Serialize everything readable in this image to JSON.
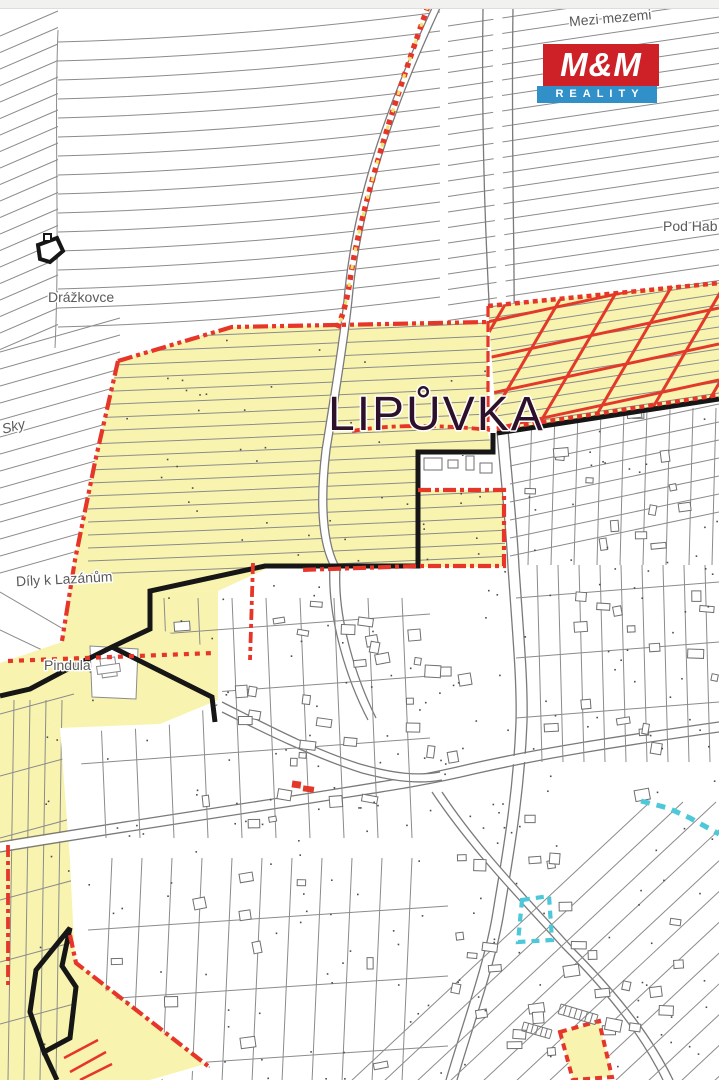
{
  "page": {
    "top_bar_color": "#f1f1ef"
  },
  "logo": {
    "brand": "M&M",
    "tagline": "REALITY",
    "red": "#ce2127",
    "blue": "#3090c7"
  },
  "map": {
    "labels": {
      "mezi_mezemi": "Mezi mezemi",
      "pod_hab": "Pod Hab",
      "drazkovce": "Drážkovce",
      "sky": "Sky",
      "dily_k_lazanum": "Díly k Lazánům",
      "pindula": "Pindula",
      "lipuvka": "LIPŮVKA"
    },
    "colors": {
      "highlight_yellow": "#f8f4b0",
      "boundary_red": "#e63529",
      "hatch_red": "#e2392b",
      "boundary_yellow_dash": "#f2e468",
      "cadastre_black": "#161616",
      "parcel_gray": "#8b8b8b",
      "road_gray": "#7a7a7a",
      "water_cyan": "#4cc8d9",
      "label_gray": "#5a5a5a",
      "title_dark": "#2d1029"
    }
  }
}
